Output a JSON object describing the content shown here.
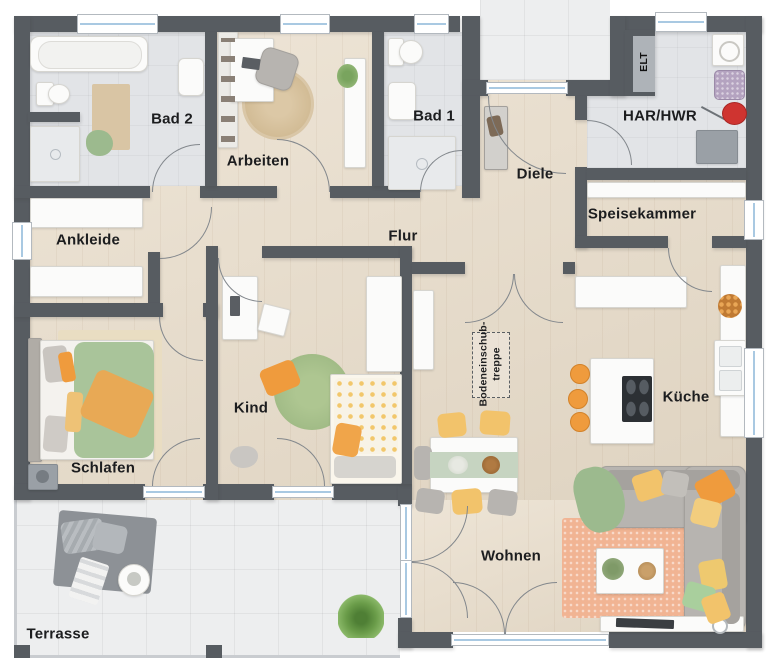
{
  "floorplan": {
    "labels": {
      "bad2": "Bad 2",
      "arbeiten": "Arbeiten",
      "bad1": "Bad 1",
      "diele": "Diele",
      "elt": "ELT",
      "har_hwr": "HAR/HWR",
      "speisekammer": "Speisekammer",
      "ankleide": "Ankleide",
      "flur": "Flur",
      "kind": "Kind",
      "schlafen": "Schlafen",
      "wohnen": "Wohnen",
      "kueche": "Küche",
      "terrasse": "Terrasse",
      "attic_line1": "Bodeneinschub-",
      "attic_line2": "treppe"
    },
    "colors": {
      "wall": "#575c61",
      "wood_floor": "#e8dcc9",
      "tile_floor": "#e2e4e7",
      "outdoor_floor": "#edeeef",
      "window_glass": "#a9c9e2",
      "accent_orange": "#ef9b3d",
      "accent_yellow": "#f2c36b",
      "accent_green": "#a9c49a",
      "sofa_gray": "#b7b4b0",
      "rug_peach": "#f1b493",
      "rug_kind_green": "#a3bd88",
      "rug_jute": "#d8c2a0"
    }
  }
}
